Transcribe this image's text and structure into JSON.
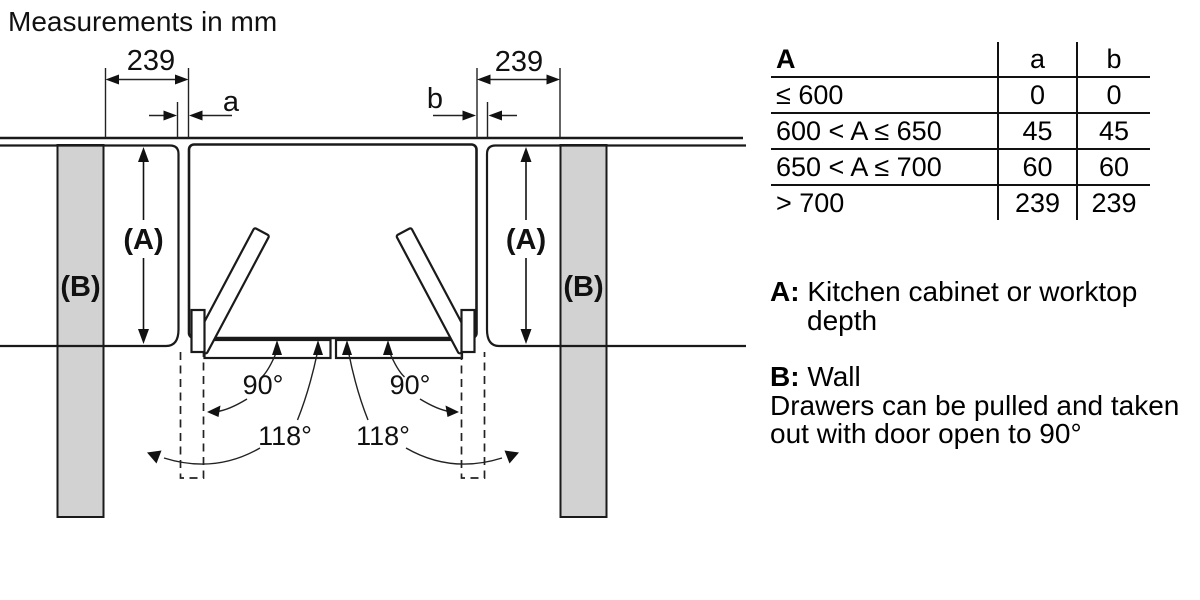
{
  "title": "Measurements in mm",
  "diagram": {
    "left_dim": "239",
    "right_dim": "239",
    "gap_a": "a",
    "gap_b": "b",
    "depth_label": "(A)",
    "wall_label": "(B)",
    "angle_open": "90°",
    "angle_max": "118°",
    "colors": {
      "wall_fill": "#d2d2d2",
      "line": "#1a1a1a"
    }
  },
  "table": {
    "col_headers": [
      "A",
      "a",
      "b"
    ],
    "rows": [
      {
        "range": "≤ 600",
        "a": "0",
        "b": "0"
      },
      {
        "range": "600 < A ≤ 650",
        "a": "45",
        "b": "45"
      },
      {
        "range": "650 < A ≤ 700",
        "a": "60",
        "b": "60"
      },
      {
        "range": "> 700",
        "a": "239",
        "b": "239"
      }
    ]
  },
  "legend": {
    "a_label": "A:",
    "a_line1": "Kitchen cabinet or worktop",
    "a_line2": "depth",
    "b_label": "B:",
    "b_text": "Wall",
    "note_line1": "Drawers can be pulled and taken",
    "note_line2": "out with door open to 90°"
  }
}
